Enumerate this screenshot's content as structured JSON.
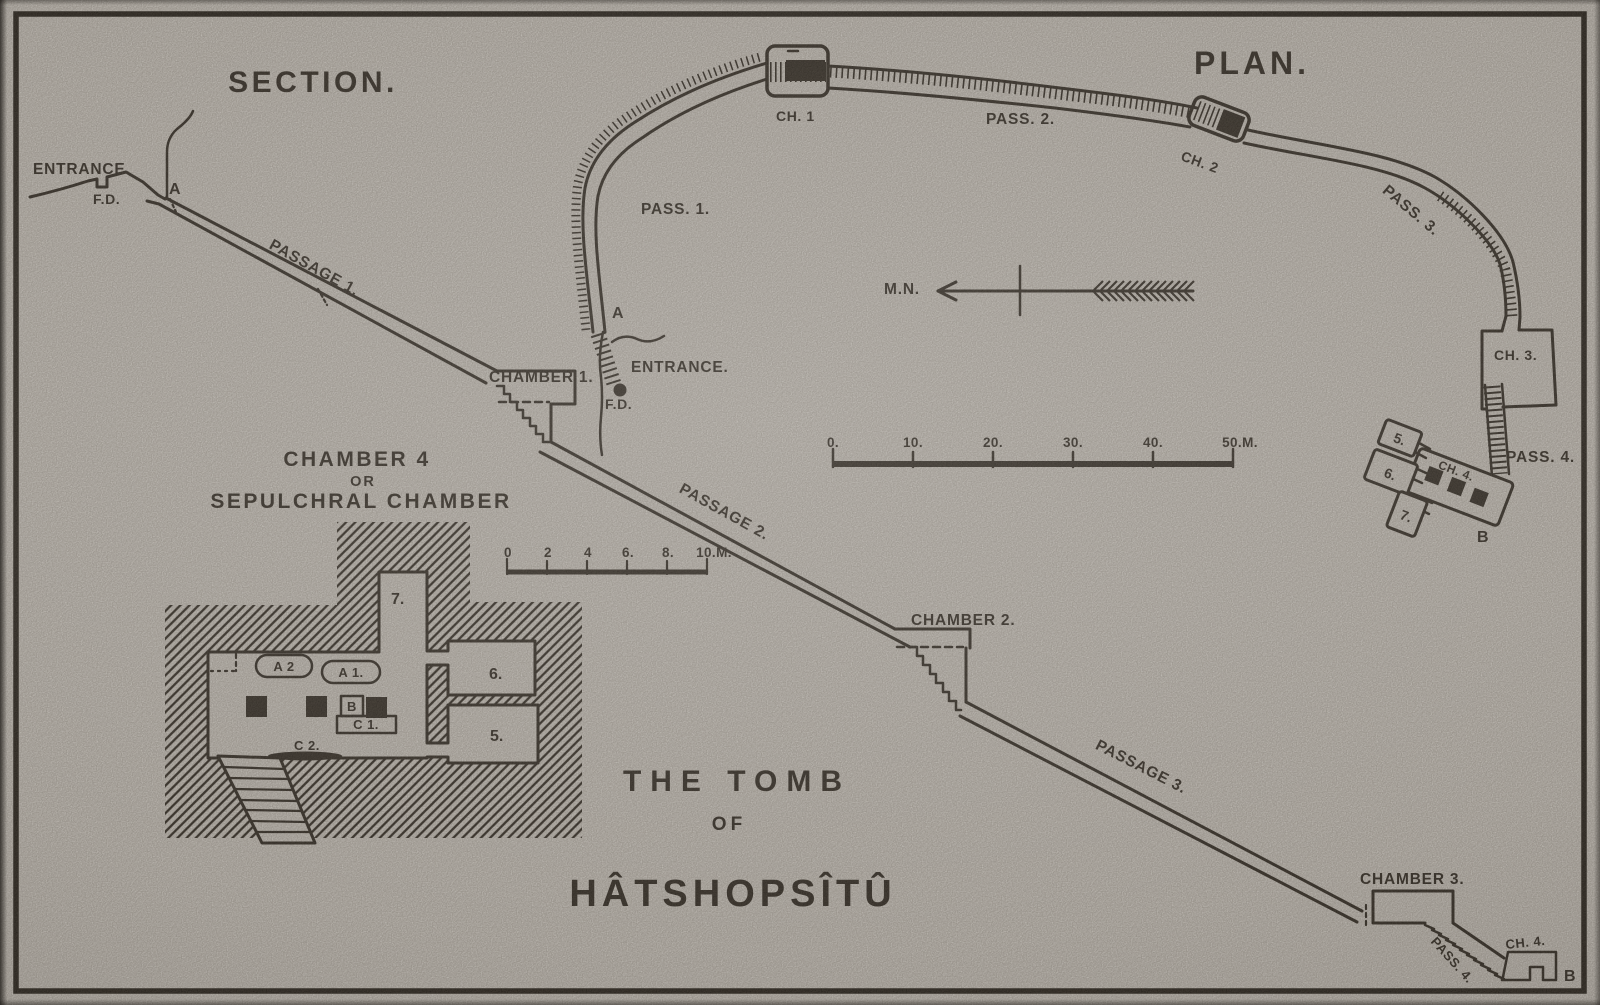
{
  "section": {
    "title": "SECTION.",
    "entrance": "ENTRANCE.",
    "fd": "F.D.",
    "a": "A",
    "passage1": "PASSAGE 1.",
    "chamber1": "CHAMBER 1.",
    "passage2": "PASSAGE 2.",
    "chamber2": "CHAMBER 2.",
    "passage3": "PASSAGE 3.",
    "chamber3": "CHAMBER 3.",
    "pass4": "PASS. 4.",
    "ch4": "CH. 4.",
    "b": "B"
  },
  "plan": {
    "title": "PLAN.",
    "entrance": "ENTRANCE.",
    "fd": "F.D.",
    "a": "A",
    "north": "M.N.",
    "pass1": "PASS. 1.",
    "ch1": "CH. 1",
    "pass2": "PASS. 2.",
    "ch2": "CH. 2",
    "pass3": "PASS. 3.",
    "ch3": "CH. 3.",
    "pass4": "PASS. 4.",
    "ch4": "CH. 4.",
    "b": "B",
    "room5": "5.",
    "room6": "6.",
    "room7": "7."
  },
  "detail": {
    "title1": "CHAMBER 4",
    "title2": "OR",
    "title3": "SEPULCHRAL CHAMBER",
    "room5": "5.",
    "room6": "6.",
    "room7": "7.",
    "a1": "A 1.",
    "a2": "A 2",
    "b": "B",
    "c1": "C 1.",
    "c2": "C 2."
  },
  "scales": {
    "plan_ticks": [
      "0.",
      "10.",
      "20.",
      "30.",
      "40.",
      "50.M."
    ],
    "detail_ticks": [
      "0",
      "2",
      "4",
      "6.",
      "8.",
      "10.M."
    ]
  },
  "caption": {
    "line1": "THE TOMB",
    "line2": "OF",
    "line3": "HÂTSHOPSÎTÛ"
  },
  "colors": {
    "paper": "#d5d2cc",
    "ink": "#211d17"
  }
}
